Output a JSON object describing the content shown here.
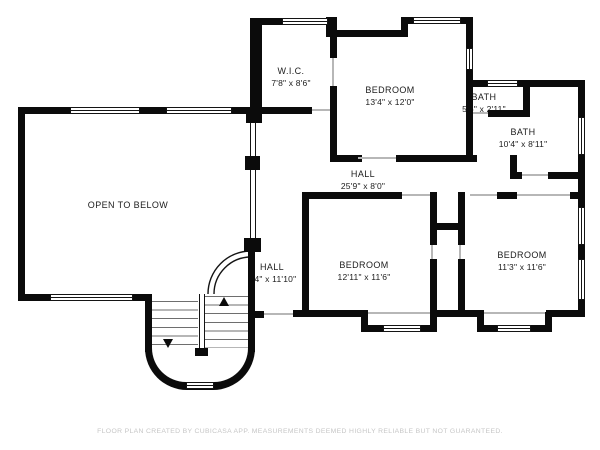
{
  "plan": {
    "rooms": {
      "wic": {
        "name": "W.I.C.",
        "dims": "7'8\" x 8'6\""
      },
      "bedroom1": {
        "name": "BEDROOM",
        "dims": "13'4\" x 12'0\""
      },
      "bath_small": {
        "name": "BATH",
        "dims": "5'6\" x 2'11\""
      },
      "bath": {
        "name": "BATH",
        "dims": "10'4\" x 8'11\""
      },
      "hall_upper": {
        "name": "HALL",
        "dims": "25'9\" x 8'0\""
      },
      "open_to_below": {
        "name": "OPEN TO BELOW"
      },
      "hall_lower": {
        "name": "HALL",
        "dims": "9'4\" x 11'10\""
      },
      "bedroom2": {
        "name": "BEDROOM",
        "dims": "12'11\" x 11'6\""
      },
      "bedroom3": {
        "name": "BEDROOM",
        "dims": "11'3\" x 11'6\""
      }
    },
    "footer": "FLOOR PLAN CREATED BY CUBICASA APP. MEASUREMENTS DEEMED HIGHLY RELIABLE BUT NOT GUARANTEED.",
    "colors": {
      "wall": "#0b0b0b",
      "background": "#ffffff",
      "footer_text": "#c6c6c6"
    }
  }
}
